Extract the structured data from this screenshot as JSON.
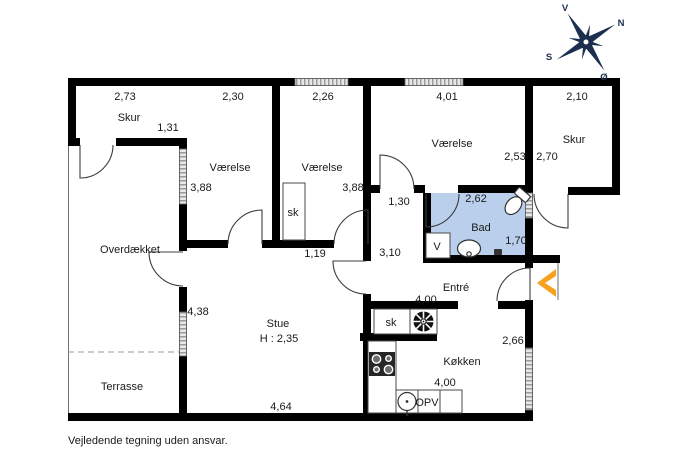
{
  "note": "Vejledende tegning uden ansvar.",
  "compass": {
    "west": "V",
    "north": "N",
    "south": "S",
    "east": "Ø"
  },
  "colors": {
    "wall": "#000000",
    "bath_floor": "#b9cfec",
    "entrance_arrow": "#f6a21e",
    "compass": "#1c2f4e"
  },
  "rooms": {
    "skur_left": {
      "name": "Skur",
      "width": "2,73",
      "depth": "1,31"
    },
    "bedroom_1": {
      "name": "Værelse",
      "width": "2,30",
      "depth": "3,88"
    },
    "bedroom_2": {
      "name": "Værelse",
      "width": "2,26",
      "depth": "3,88"
    },
    "bedroom_3": {
      "name": "Værelse",
      "width": "4,01",
      "depth": "2,53"
    },
    "skur_right": {
      "name": "Skur",
      "width": "2,10",
      "depth": "2,70"
    },
    "bathroom": {
      "name": "Bad",
      "width": "2,62",
      "depth": "1,70",
      "vent": "V"
    },
    "hallway": {
      "width": "1,30",
      "length": "3,10",
      "closet_wall": "1,19"
    },
    "covered": {
      "name": "Overdækket"
    },
    "terrace": {
      "name": "Terrasse"
    },
    "living": {
      "name": "Stue",
      "ceiling_height": "H : 2,35",
      "width": "4,64",
      "side": "4,38"
    },
    "entry": {
      "name": "Entré",
      "width": "4,00"
    },
    "kitchen": {
      "name": "Køkken",
      "width": "4,00",
      "depth": "2,66",
      "dishwasher": "OPV"
    },
    "closet_bedroom": {
      "name": "sk"
    },
    "closet_entry": {
      "name": "sk"
    }
  }
}
